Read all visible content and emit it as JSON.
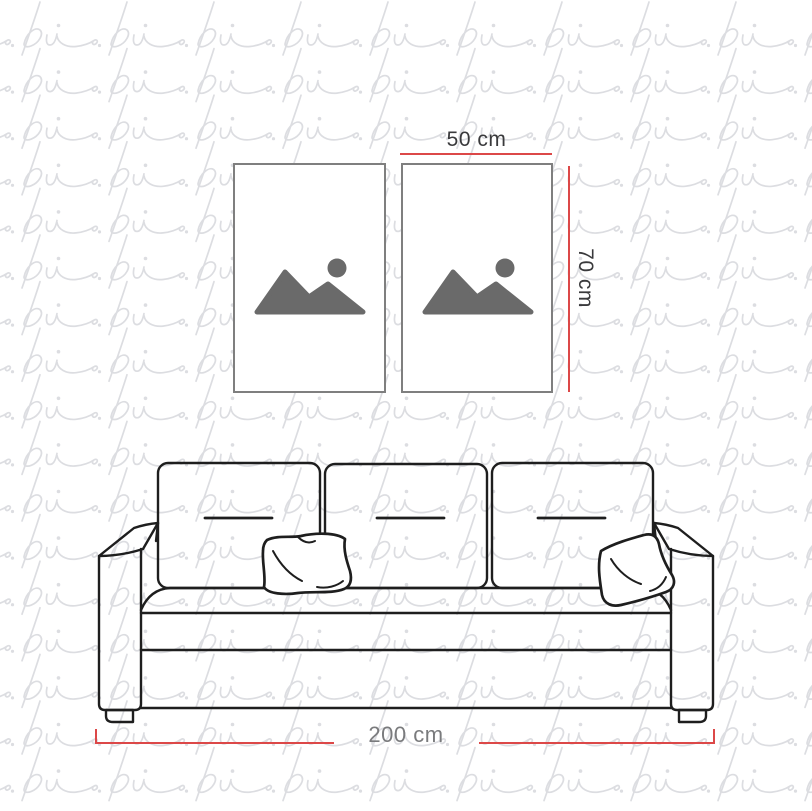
{
  "image": {
    "kind": "wall-art-size-mockup",
    "background_color": "#ffffff"
  },
  "watermark": {
    "glyph": "pi",
    "color": "#dcdde1"
  },
  "frames": {
    "border_color": "#7f7f7f",
    "fill_color": "#ffffff",
    "placeholder_icon_color": "#6a6a6a",
    "items": [
      {
        "id": "left-poster"
      },
      {
        "id": "right-poster"
      }
    ]
  },
  "sofa": {
    "outline_color": "#1e1e1e",
    "back_cushions": 3,
    "throw_pillows": 2
  },
  "dimensions": {
    "line_color": "#dc4848",
    "frame_width_label": {
      "text": "50 cm",
      "color": "#3a3a3c"
    },
    "frame_height_label": {
      "text": "70 cm",
      "color": "#3a3a3c"
    },
    "sofa_width_label": {
      "text": "200 cm",
      "color": "#7a7b7d"
    }
  }
}
